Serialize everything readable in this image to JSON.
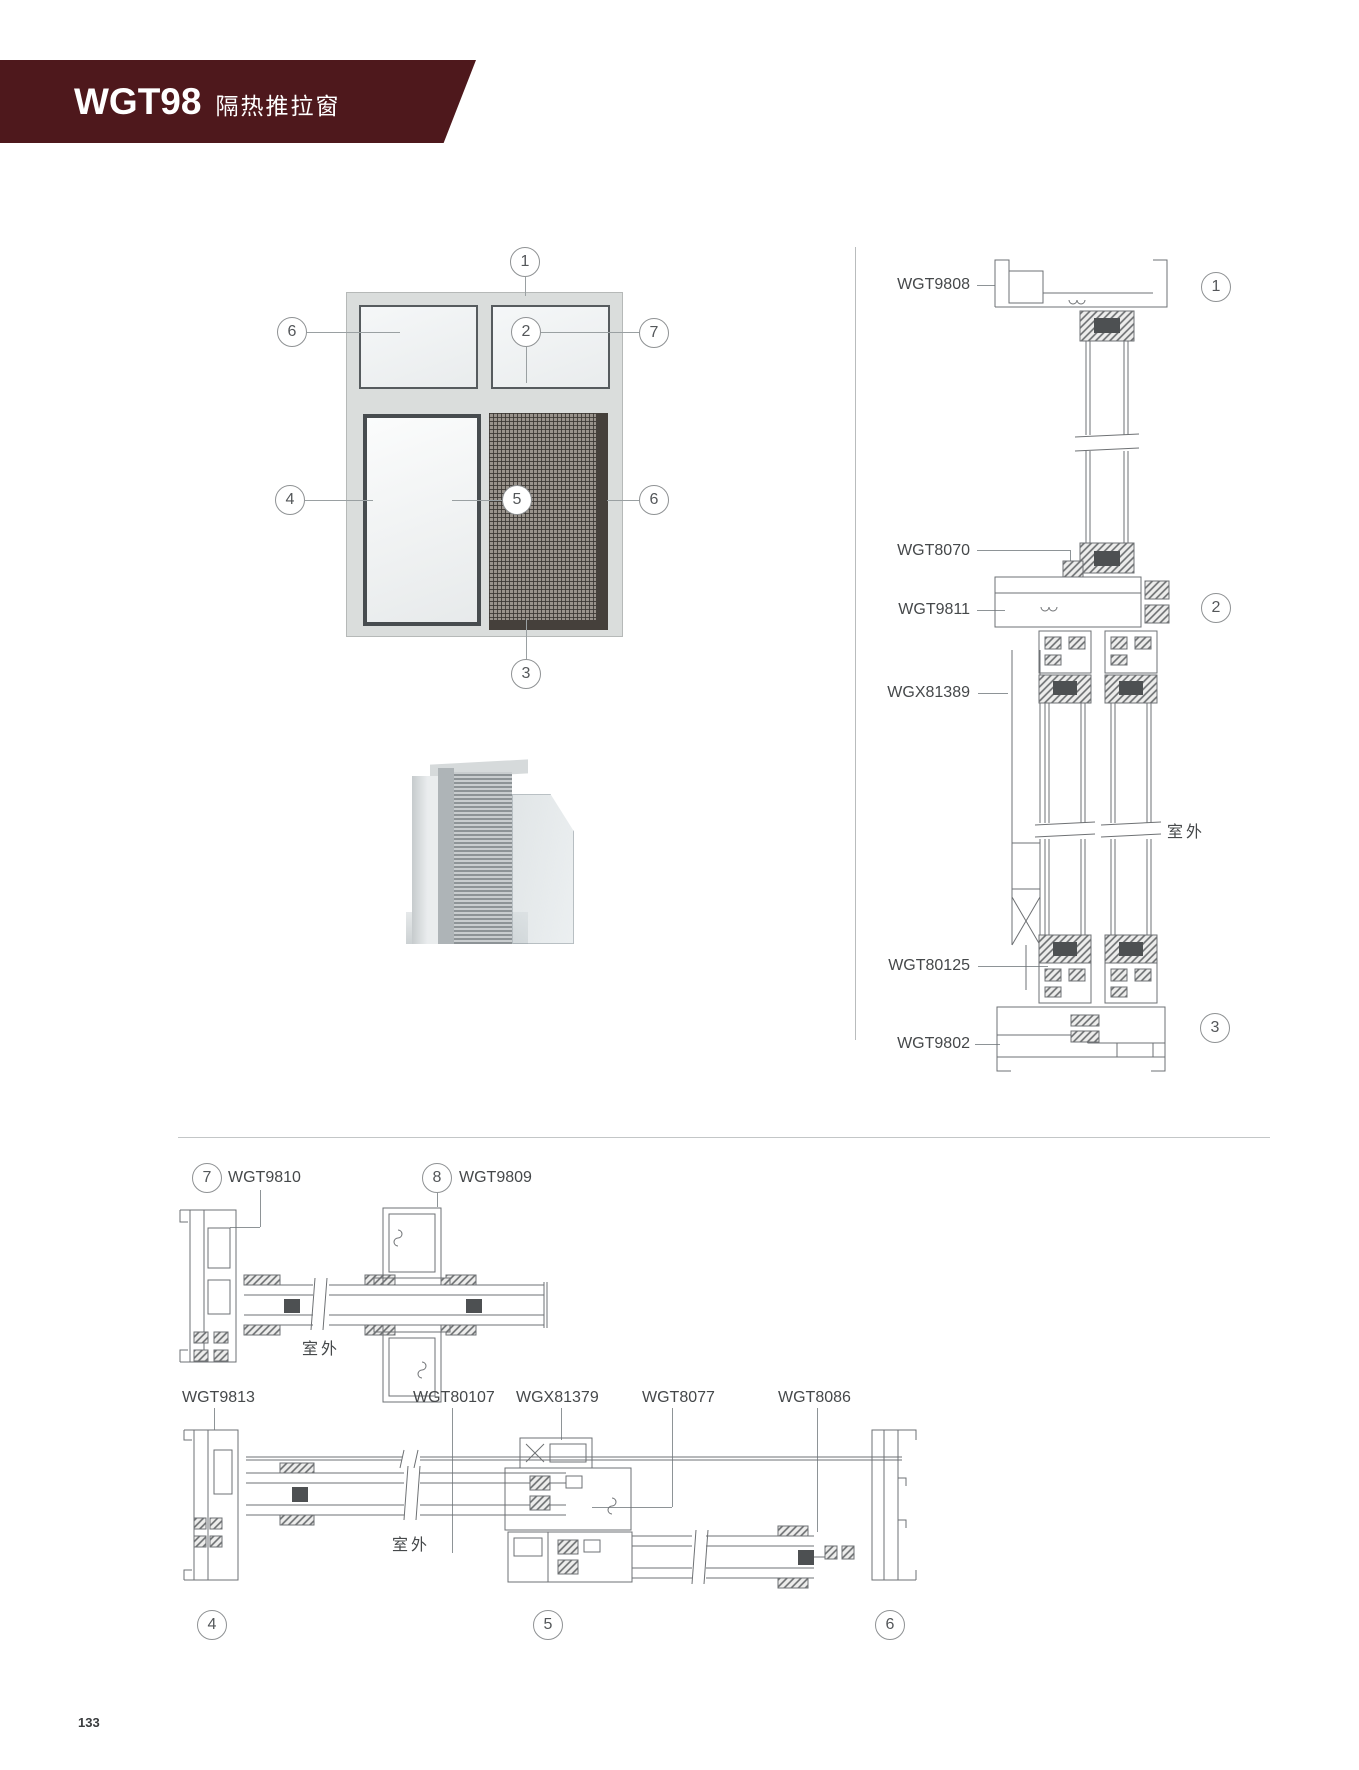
{
  "header": {
    "code": "WGT98",
    "name": "隔热推拉窗",
    "banner_color": "#4e181c"
  },
  "elevation": {
    "callouts": [
      {
        "n": "1"
      },
      {
        "n": "2"
      },
      {
        "n": "3"
      },
      {
        "n": "4"
      },
      {
        "n": "5"
      },
      {
        "n": "6"
      },
      {
        "n": "6"
      },
      {
        "n": "7"
      }
    ]
  },
  "vertical_section": {
    "labels": [
      "WGT9808",
      "WGT8070",
      "WGT9811",
      "WGX81389",
      "WGT80125",
      "WGT9802"
    ],
    "callouts": [
      "1",
      "2",
      "3"
    ],
    "outside": "室外"
  },
  "horizontal_section_top": {
    "callouts": [
      {
        "n": "7",
        "label": "WGT9810"
      },
      {
        "n": "8",
        "label": "WGT9809"
      }
    ],
    "outside": "室外"
  },
  "horizontal_section_bottom": {
    "labels": [
      "WGT9813",
      "WGT80107",
      "WGX81379",
      "WGT8077",
      "WGT8086"
    ],
    "callouts": [
      "4",
      "5",
      "6"
    ],
    "outside": "室外"
  },
  "page": {
    "number": "133"
  }
}
